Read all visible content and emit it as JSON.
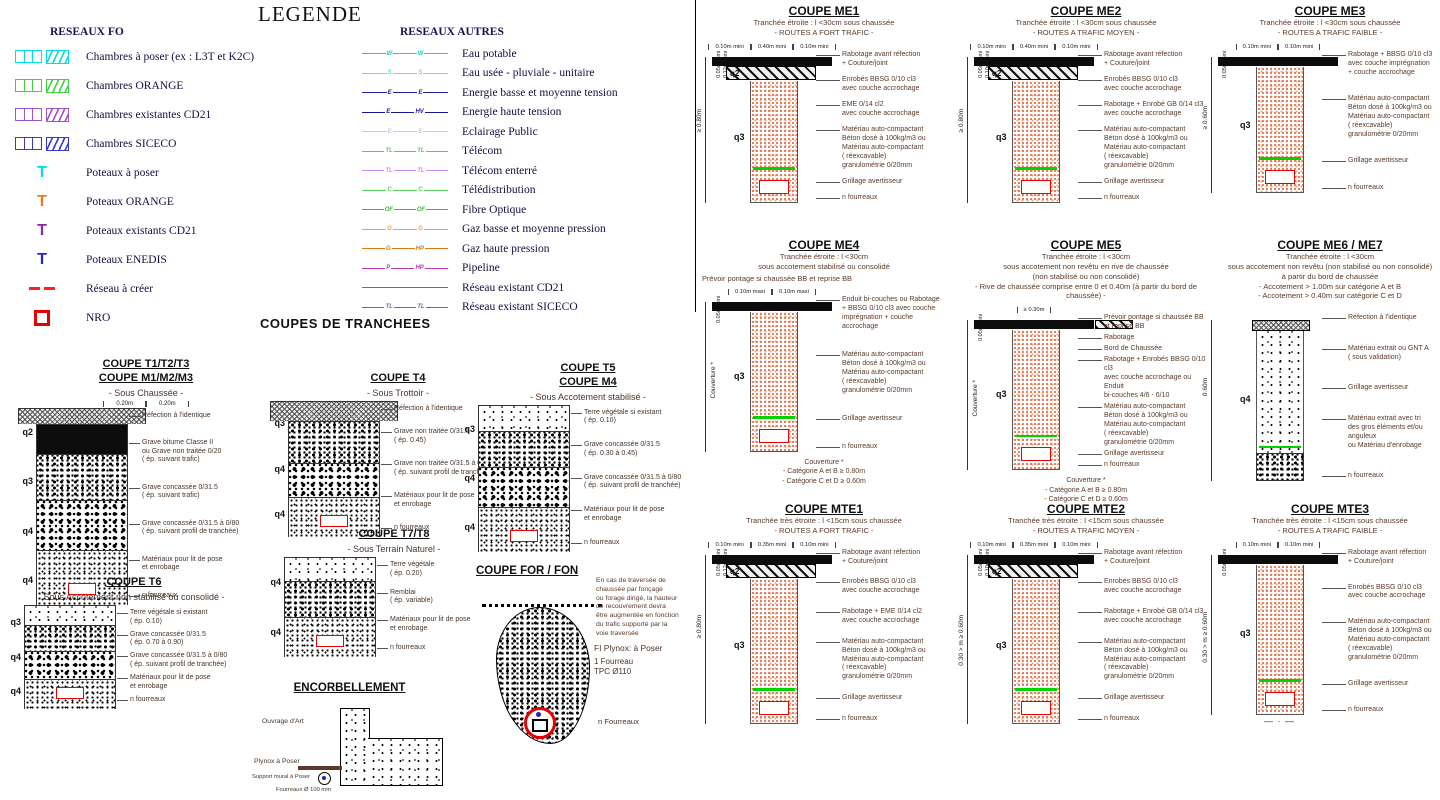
{
  "page": {
    "title": "LEGENDE",
    "coupes_title": "COUPES DE TRANCHEES"
  },
  "legend_fo": {
    "header": "RESEAUX FO",
    "items": [
      {
        "label": "Chambres à poser (ex : L3T et K2C)",
        "symbol": "chambers",
        "color": "#00dce8"
      },
      {
        "label": "Chambres ORANGE",
        "symbol": "chambers",
        "color": "#3fd43f"
      },
      {
        "label": "Chambres existantes CD21",
        "symbol": "chambers",
        "color": "#a050c8"
      },
      {
        "label": "Chambres SICECO",
        "symbol": "chambers",
        "color": "#3838d0"
      },
      {
        "label": "Poteaux à poser",
        "symbol": "pole",
        "color": "#00dce8"
      },
      {
        "label": "Poteaux ORANGE",
        "symbol": "pole",
        "color": "#f07818"
      },
      {
        "label": "Poteaux existants CD21",
        "symbol": "pole",
        "color": "#8a28a8"
      },
      {
        "label": "Poteaux ENEDIS",
        "symbol": "pole",
        "color": "#2828c8"
      },
      {
        "label": "Réseau à créer",
        "symbol": "dashes",
        "color": "#ff2020"
      },
      {
        "label": "NRO",
        "symbol": "nro",
        "color": "#e80000"
      }
    ]
  },
  "legend_autres": {
    "header": "RESEAUX AUTRES",
    "items": [
      {
        "label": "Eau potable",
        "color": "#00d8d8",
        "m1": "W",
        "m2": "W"
      },
      {
        "label": "Eau usée - pluviale - unitaire",
        "color": "#58e4e4",
        "m1": "S",
        "m2": "S"
      },
      {
        "label": "Energie basse et moyenne tension",
        "color": "#2020a8",
        "m1": "E",
        "m2": "E"
      },
      {
        "label": "Energie haute tension",
        "color": "#181890",
        "m1": "E",
        "m2": "HV"
      },
      {
        "label": "Eclairage Public",
        "color": "#c6c6ee",
        "m1": "E",
        "m2": "E"
      },
      {
        "label": "Télécom",
        "color": "#58cc58",
        "m1": "TL",
        "m2": "TL"
      },
      {
        "label": "Télécom enterré",
        "color": "#cc8cee",
        "m1": "TL",
        "m2": "TL"
      },
      {
        "label": "Télédistribution",
        "color": "#58cc58",
        "m1": "C",
        "m2": "C"
      },
      {
        "label": "Fibre Optique",
        "color": "#38bc38",
        "m1": "OF",
        "m2": "OF"
      },
      {
        "label": "Gaz basse et moyenne pression",
        "color": "#eca438",
        "m1": "G",
        "m2": "G"
      },
      {
        "label": "Gaz haute pression",
        "color": "#dc7810",
        "m1": "G",
        "m2": "HP"
      },
      {
        "label": "Pipeline",
        "color": "#b838b8",
        "m1": "P",
        "m2": "HP"
      },
      {
        "label": "Réseau existant CD21",
        "color": "#8858b8",
        "m1": null,
        "m2": null
      },
      {
        "label": "Réseau existant SICECO",
        "color": "#8858b8",
        "m1": "TL",
        "m2": "TL"
      }
    ]
  },
  "t_coupes": [
    {
      "id": "t1",
      "x": 20,
      "y": 358,
      "titles": [
        "COUPE T1/T2/T3",
        "COUPE M1/M2/M3"
      ],
      "subtitle": "- Sous Chaussée -",
      "top_dims": [
        "0.20m",
        "0.20m"
      ],
      "layers": [
        {
          "tex": "tex-refection",
          "h": 16,
          "wide": true
        },
        {
          "tex": "tex-asphalt",
          "h": 30
        },
        {
          "tex": "tex-cobble",
          "h": 46
        },
        {
          "tex": "tex-cobble2",
          "h": 50
        },
        {
          "tex": "tex-stipple",
          "h": 55
        }
      ],
      "q": [
        "q2",
        "q3",
        "q4",
        "q4"
      ],
      "labels": [
        "Réfection à l'identique",
        "Grave bitume Classe II\nou Grave non traitée 0/20\n( ép. suivant trafic)",
        "Grave concassée 0/31.5\n( ép. suivant trafic)",
        "Grave concassée 0/31.5 à 0/80\n( ép. suivant profil de tranchée)",
        "Matériaux pour lit de pose\net enrobage",
        "n fourreaux"
      ]
    },
    {
      "id": "t4",
      "x": 272,
      "y": 372,
      "titles": [
        "COUPE T4"
      ],
      "subtitle": "- Sous Trottoir -",
      "top_dims": [],
      "layers": [
        {
          "tex": "tex-refection",
          "h": 20,
          "wide": true
        },
        {
          "tex": "tex-cobble",
          "h": 42
        },
        {
          "tex": "tex-cobble2",
          "h": 34
        },
        {
          "tex": "tex-stipple",
          "h": 40
        }
      ],
      "q": [
        "q3",
        "q4",
        "q4"
      ],
      "labels": [
        "Réfection à l'identique",
        "Grave non traitée 0/31.5\n( ép. 0.45)",
        "Grave non traitée 0/31.5 à 0/80\n( ép. suivant profil de tranchée)",
        "Matériaux pour lit de pose\net enrobage",
        "n fourreaux"
      ]
    },
    {
      "id": "t7",
      "x": 268,
      "y": 528,
      "titles": [
        "COUPE T7/T8"
      ],
      "subtitle": "- Sous Terrain Naturel -",
      "top_dims": [],
      "layers": [
        {
          "tex": "tex-topsoil",
          "h": 24
        },
        {
          "tex": "tex-cobble",
          "h": 36
        },
        {
          "tex": "tex-stipple",
          "h": 40
        }
      ],
      "q": [
        "q4",
        "q4"
      ],
      "labels": [
        "Terre végétale\n( ép. 0.20)",
        "Remblai\n( ép. variable)",
        "Matériaux pour lit de pose\net enrobage",
        "n fourreaux"
      ]
    },
    {
      "id": "t5",
      "x": 462,
      "y": 362,
      "titles": [
        "COUPE T5",
        "COUPE M4"
      ],
      "subtitle": "- Sous Accotement stabilisé -",
      "top_dims": [],
      "layers": [
        {
          "tex": "tex-topsoil",
          "h": 26
        },
        {
          "tex": "tex-cobble",
          "h": 36
        },
        {
          "tex": "tex-cobble2",
          "h": 40
        },
        {
          "tex": "tex-stipple",
          "h": 45
        }
      ],
      "q": [
        "q3",
        "q4",
        "q4"
      ],
      "labels": [
        "Terre végétale si existant\n( ép. 0.10)",
        "Grave concassée 0/31.5\n( ép. 0.30 à 0.45)",
        "Grave concassée 0/31.5 à 0/80\n( ép. suivant profil de tranchée)",
        "Matériaux pour lit de pose\net enrobage",
        "n fourreaux"
      ]
    },
    {
      "id": "t6",
      "x": 8,
      "y": 576,
      "titles": [
        "COUPE T6"
      ],
      "subtitle": "Sous Accotement non stabilisé ou consolidé -",
      "top_dims": [],
      "layers": [
        {
          "tex": "tex-topsoil",
          "h": 20
        },
        {
          "tex": "tex-cobble",
          "h": 26
        },
        {
          "tex": "tex-cobble2",
          "h": 28
        },
        {
          "tex": "tex-stipple",
          "h": 30
        }
      ],
      "q": [
        "q3",
        "q4",
        "q4"
      ],
      "labels": [
        "Terre végétale si existant\n( ép. 0.10)",
        "Grave concassée 0/31.5\n( ép. 0.70 à 0.90)",
        "Grave concassée 0/31.5 à 0/80\n( ép. suivant profil de tranchée)",
        "Matériaux pour lit de pose\net enrobage",
        "n fourreaux"
      ]
    }
  ],
  "encorbellement": {
    "title": "ENCORBELLEMENT",
    "labels": {
      "ouvrage": "Ouvrage d'Art",
      "plynox": "Plynox à Poser",
      "support": "Support mural à Poser",
      "fourreaux": "Fourreaux Ø 100 mm"
    }
  },
  "for_fon": {
    "title": "COUPE FOR / FON",
    "note": "En cas de traversée de\nchaussée par fonçage\nou forage dirigé, la hauteur\nde recouvrement devra\nêtre augmentée en fonction\ndu trafic supporté par la\nvoie traversée",
    "labels": {
      "plynox": "FI Plynox: à Poser",
      "fourreau": "1 Fourreau\nTPC Ø110",
      "n_fourreaux": "n Fourreaux"
    }
  },
  "me_coupes": [
    {
      "id": "me1",
      "x": 700,
      "y": 4,
      "title": "COUPE ME1",
      "subtitles": [
        "Tranchée étroite : l <30cm sous chaussée",
        "- ROUTES A FORT TRAFIC -"
      ],
      "top_dims": [
        "0.10m mini",
        "0.40m mini",
        "0.10m mini"
      ],
      "rot_dims": [
        "0.05m mini",
        "0.12m mini"
      ],
      "left_dim": "≥ 0.80m",
      "cap": "black+hatch",
      "trench": "tex-salmon",
      "trench_h": 122,
      "q2": "q2",
      "q3": "q3",
      "labels": [
        "Rabotage avant réfection\n+ Couture/joint",
        "Enrobés BBSG 0/10 cl3\navec couche accrochage",
        "EME 0/14 cl2\navec couche accrochage",
        "Matériau auto-compactant\nBéton dosé à 100kg/m3 ou\nMatériau auto-compactant\n( réexcavable)\ngranulométrie 0/20mm",
        "Grillage avertisseur",
        "n fourreaux"
      ]
    },
    {
      "id": "me2",
      "x": 962,
      "y": 4,
      "title": "COUPE ME2",
      "subtitles": [
        "Tranchée étroite : l <30cm sous chaussée",
        "- ROUTES A TRAFIC MOYEN -"
      ],
      "top_dims": [
        "0.10m mini",
        "0.40m mini",
        "0.10m mini"
      ],
      "rot_dims": [
        "0.05m mini",
        "0.10m mini"
      ],
      "left_dim": "≥ 0.80m",
      "cap": "black+hatch",
      "trench": "tex-salmon",
      "trench_h": 122,
      "q2": "q2",
      "q3": "q3",
      "labels": [
        "Rabotage avant réfection\n+ Couture/joint",
        "Enrobés BBSG 0/10 cl3\navec couche accrochage",
        "Rabotage + Enrobé GB 0/14 cl3\navec couche accrochage",
        "Matériau auto-compactant\nBéton dosé à 100kg/m3 ou\nMatériau auto-compactant\n( réexcavable)\ngranulométrie 0/20mm",
        "Grillage avertisseur",
        "n fourreaux"
      ]
    },
    {
      "id": "me3",
      "x": 1206,
      "y": 4,
      "title": "COUPE ME3",
      "subtitles": [
        "Tranchée étroite : l <30cm sous chaussée",
        "- ROUTES A TRAFIC FAIBLE -"
      ],
      "top_dims": [
        "0.10m mini",
        "0.10m mini"
      ],
      "rot_dims": [
        "0.05m mini"
      ],
      "left_dim": "≥ 0.60m",
      "cap": "black",
      "trench": "tex-salmon",
      "trench_h": 126,
      "q3": "q3",
      "labels": [
        "Rabotage + BBSG 0/10 cl3\navec couche imprégnation\n+ couche accrochage",
        "Matériau auto-compactant\nBéton dosé à 100kg/m3 ou\nMatériau auto-compactant\n( réexcavable)\ngranulométrie 0/20mm",
        "Grillage avertisseur",
        "n fourreaux"
      ]
    },
    {
      "id": "me4",
      "x": 700,
      "y": 238,
      "title": "COUPE ME4",
      "subtitles": [
        "Tranchée étroite : l <30cm",
        "sous accotement stabilisé ou consolidé"
      ],
      "pre_note": "Prévoir pontage si chaussée BB et reprise BB",
      "top_dims": [
        "0.10m maxi",
        "0.10m maxi"
      ],
      "rot_dims": [
        "0.05m mini"
      ],
      "left_rot": "Couverture *",
      "cap": "black",
      "trench": "tex-salmon",
      "trench_h": 140,
      "q3": "q3",
      "labels": [
        "Enduit bi-couches ou Rabotage\n+ BBSG 0/10 cl3 avec couche\nimprégnation + couche accrochage",
        "Matériau auto-compactant\nBéton dosé à 100kg/m3 ou\nMatériau auto-compactant\n( réexcavable)\ngranulométrie 0/20mm",
        "Grillage avertisseur",
        "n fourreaux"
      ],
      "bottom": [
        "Couverture *",
        "- Catégorie A et B ≥ 0.80m",
        "- Catégorie C et D ≥ 0.60m"
      ]
    },
    {
      "id": "me5",
      "x": 962,
      "y": 238,
      "title": "COUPE ME5",
      "subtitles": [
        "Tranchée étroite : l <30cm",
        "sous accotement non revêtu en rive de chaussée",
        "(non stabilisé ou non consolidé)",
        "- Rive de chaussée comprise entre 0 et 0.40m (à partir du bord de chaussée) -"
      ],
      "top_dims": [
        "≥ 0.30m"
      ],
      "rot_dims": [
        "0.05m mini"
      ],
      "left_rot": "Couverture *",
      "cap": "black",
      "side_hatch": true,
      "trench": "tex-salmon",
      "trench_h": 140,
      "q3": "q3",
      "labels": [
        "Prévoir pontage si chaussée BB\net reprise BB",
        "Rabotage",
        "Bord de Chaussée",
        "Rabotage + Enrobés BBSG 0/10 cl3\navec couche accrochage ou Enduit\nbi-couches 4/6 - 6/10",
        "Matériau auto-compactant\nBéton dosé à 100kg/m3 ou\nMatériau auto-compactant\n( réexcavable)\ngranulométrie 0/20mm",
        "Grillage avertisseur",
        "n fourreaux"
      ],
      "bottom": [
        "Couverture *",
        "- Catégorie A et B ≥ 0.80m",
        "- Catégorie C et D ≥ 0.60m"
      ]
    },
    {
      "id": "me6",
      "x": 1206,
      "y": 238,
      "title": "COUPE ME6 / ME7",
      "subtitles": [
        "Tranchée étroite : l <30cm",
        "sous accotement non revêtu (non stabilisé ou non consolidé)",
        "à partir du bord de chaussée",
        "- Accotement > 1.00m sur catégorie A et B",
        "- Accotement > 0.40m sur catégorie C et D"
      ],
      "top_dims": [],
      "rot_dims": [],
      "left_dim": "0.60m",
      "cap": "refection",
      "trench": "tex-topsoil",
      "trench_h": 150,
      "q3": "q4",
      "bottom_band": true,
      "labels": [
        "Réfection à l'identique",
        "Matériau extrait ou GNT A\n( sous validation)",
        "Grillage avertisseur",
        "Matériau extrait avec tri\ndes gros éléments et/ou anguleux\nou Matériau d'enrobage",
        "n fourreaux"
      ]
    },
    {
      "id": "mte1",
      "x": 700,
      "y": 502,
      "title": "COUPE MTE1",
      "subtitles": [
        "Tranchée très étroite : l <15cm sous chaussée",
        "- ROUTES A FORT TRAFIC -"
      ],
      "top_dims": [
        "0.10m mini",
        "0.35m mini",
        "0.10m mini"
      ],
      "rot_dims": [
        "0.05m mini",
        "0.12m mini"
      ],
      "left_dim": "≥ 0.80m",
      "cap": "black+hatch",
      "trench": "tex-salmon",
      "trench_h": 145,
      "q2": "q2",
      "q3": "q3",
      "labels": [
        "Rabotage avant réfection\n+ Couture/joint",
        "Enrobés BBSG 0/10 cl3\navec couche accrochage",
        "Rabotage + EME 0/14 cl2\navec couche accrochage",
        "Matériau auto-compactant\nBéton dosé à 100kg/m3 ou\nMatériau auto-compactant\n( réexcavable)\ngranulométrie 0/20mm",
        "Grillage avertisseur",
        "n fourreaux"
      ]
    },
    {
      "id": "mte2",
      "x": 962,
      "y": 502,
      "title": "COUPE MTE2",
      "subtitles": [
        "Tranchée très étroite : l <15cm sous chaussée",
        "- ROUTES A TRAFIC MOYEN -"
      ],
      "top_dims": [
        "0.10m mini",
        "0.35m mini",
        "0.10m mini"
      ],
      "rot_dims": [
        "0.05m mini",
        "0.10m mini"
      ],
      "left_dim": "0.30 > m ≥ 0.60m",
      "cap": "black+hatch",
      "trench": "tex-salmon",
      "trench_h": 145,
      "q2": "q2",
      "q3": "q3",
      "labels": [
        "Rabotage avant réfection\n+ Couture/joint",
        "Enrobés BBSG 0/10 cl3\navec couche accrochage",
        "Rabotage + Enrobé GB 0/14 cl3\navec couche accrochage",
        "Matériau auto-compactant\nBéton dosé à 100kg/m3 ou\nMatériau auto-compactant\n( réexcavable)\ngranulométrie 0/20mm",
        "Grillage avertisseur",
        "n fourreaux"
      ]
    },
    {
      "id": "mte3",
      "x": 1206,
      "y": 502,
      "title": "COUPE MTE3",
      "subtitles": [
        "Tranchée très étroite : l <15cm sous chaussée",
        "- ROUTES A TRAFIC FAIBLE -"
      ],
      "top_dims": [
        "0.10m mini",
        "0.10m mini"
      ],
      "rot_dims": [
        "0.05m mini"
      ],
      "left_dim": "0.30 > m ≥ 0.60m",
      "cap": "black",
      "trench": "tex-salmon",
      "trench_h": 150,
      "q3": "q3",
      "axis_mark": true,
      "labels": [
        "Rabotage avant réfection\n+ Couture/joint",
        "Enrobés BBSG 0/10 cl3\navec couche accrochage",
        "Matériau auto-compactant\nBéton dosé à 100kg/m3 ou\nMatériau auto-compactant\n( réexcavable)\ngranulométrie 0/20mm",
        "Grillage avertisseur",
        "n fourreaux"
      ]
    }
  ]
}
